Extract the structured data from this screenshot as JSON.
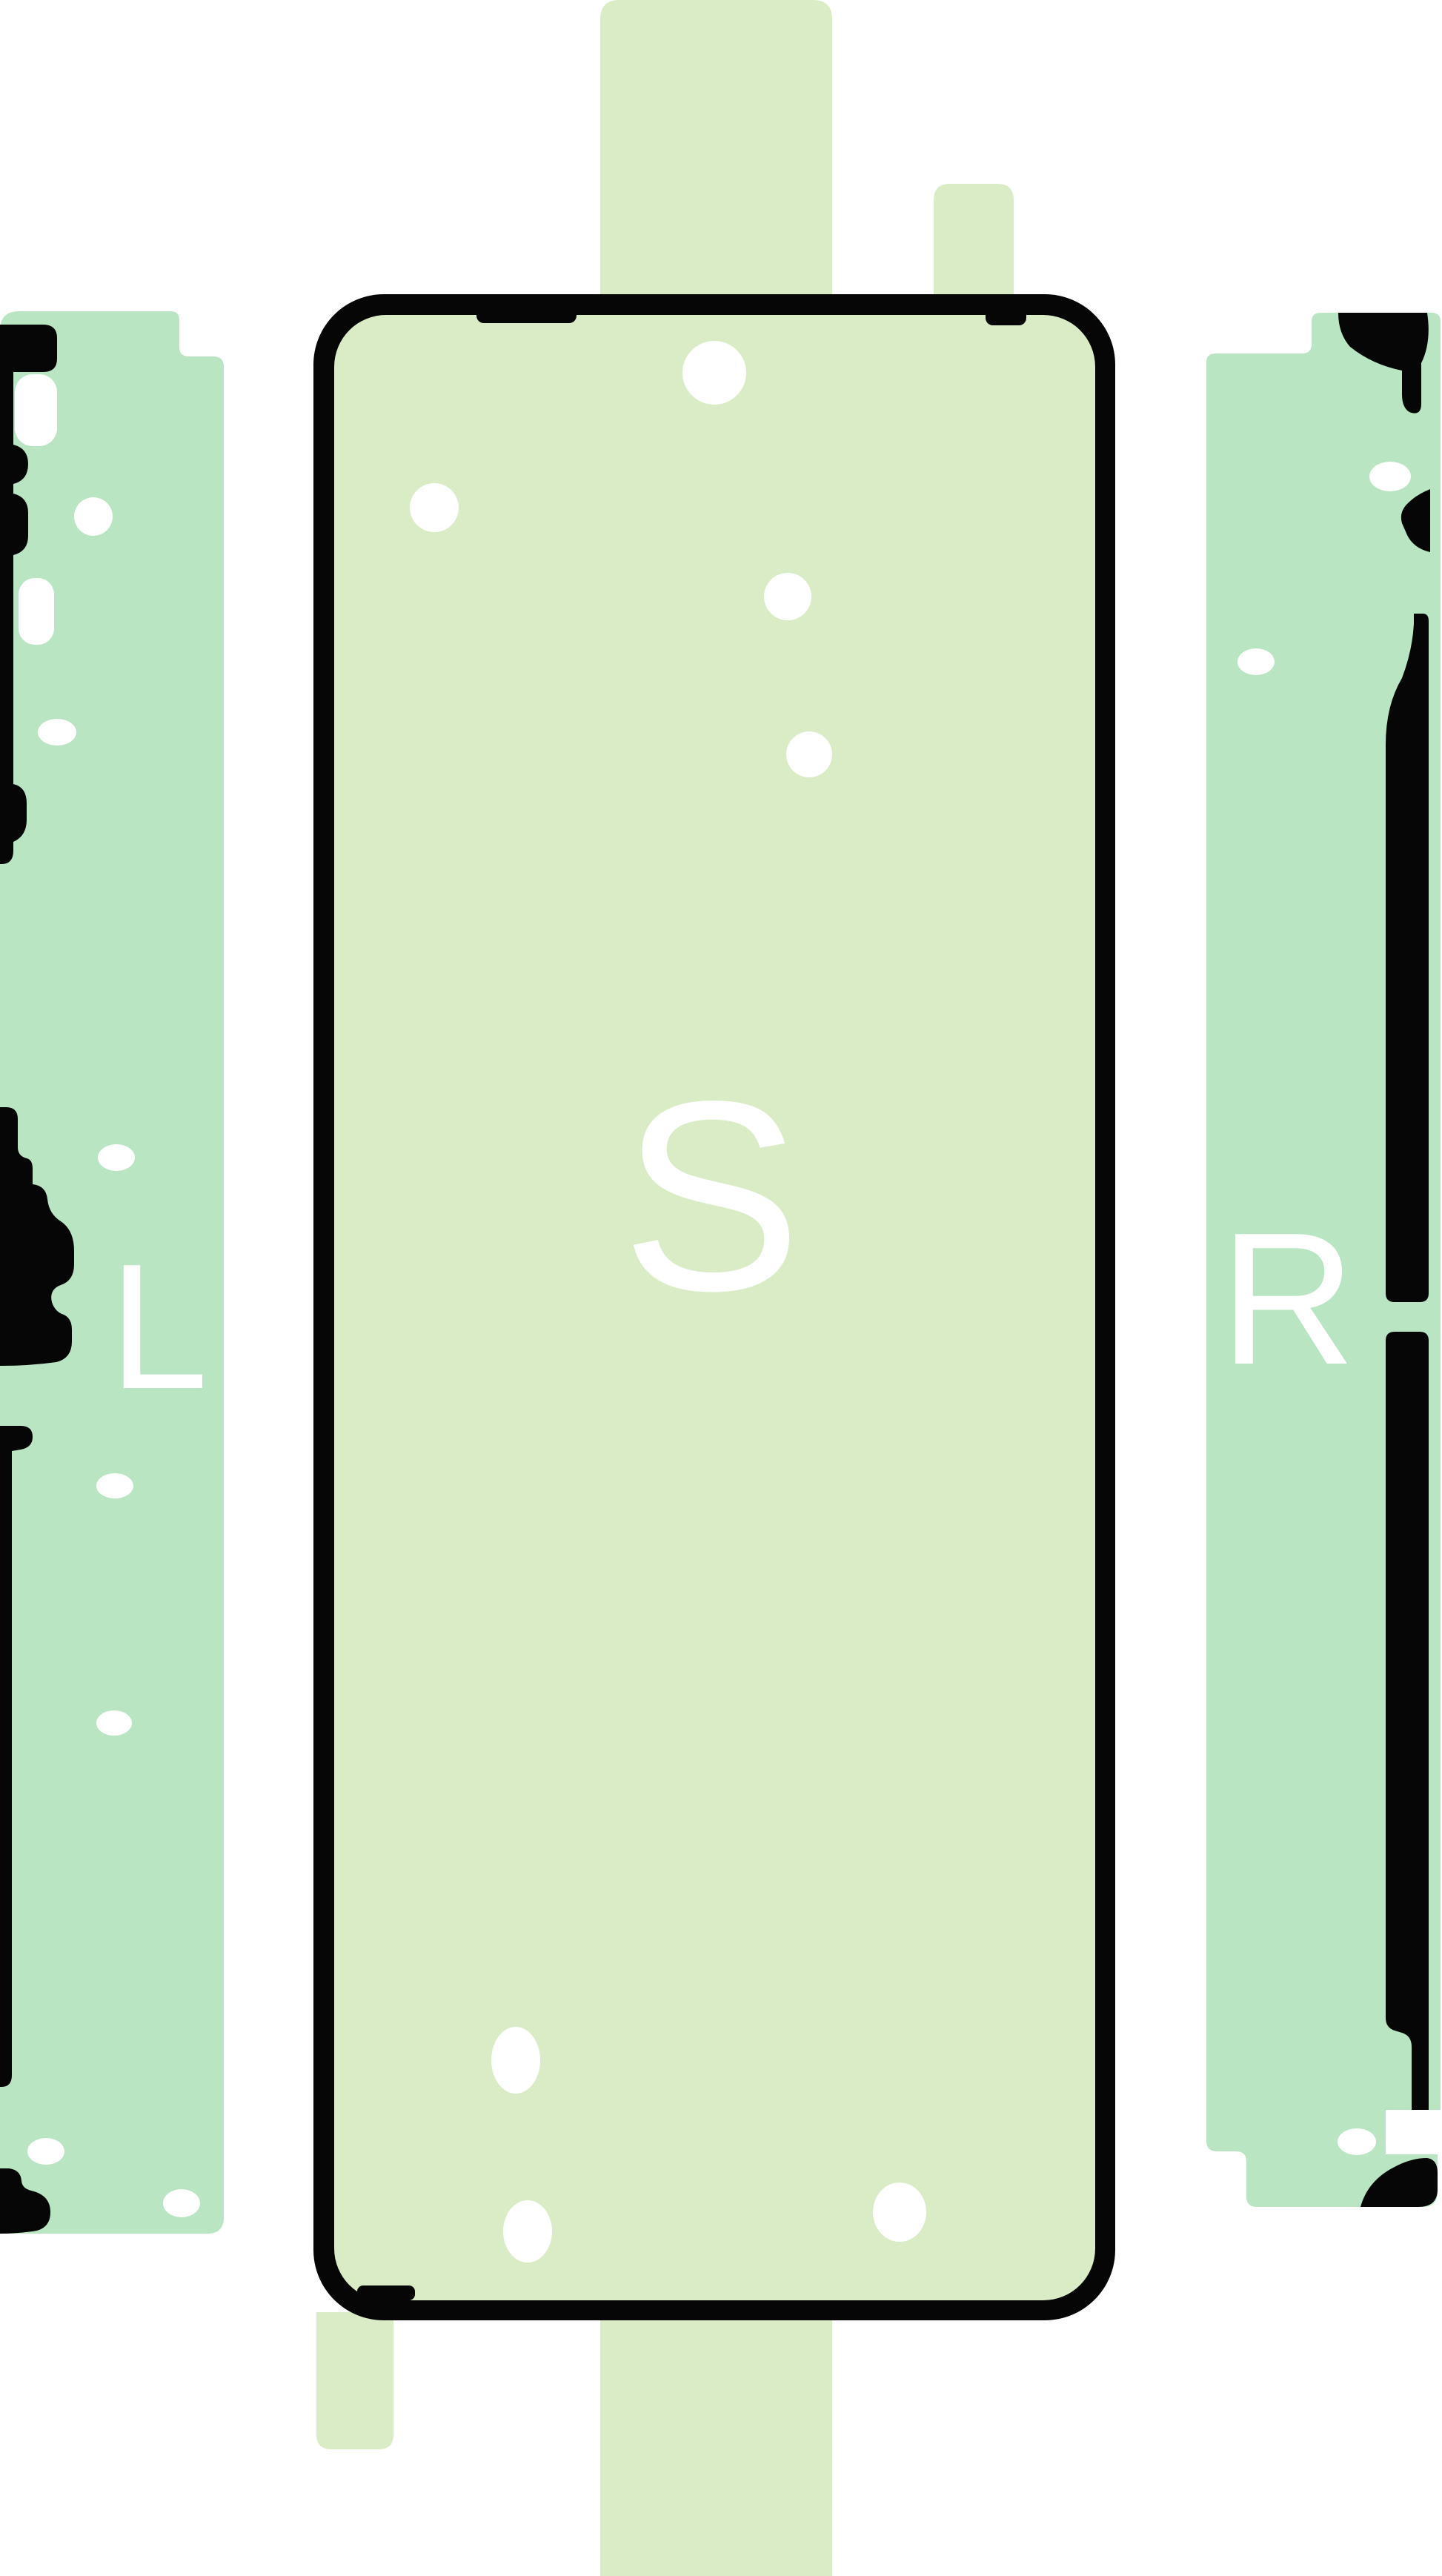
{
  "pieces": {
    "left_strip": {
      "label": "L"
    },
    "center_sheet": {
      "label": "S"
    },
    "right_strip": {
      "label": "R"
    }
  },
  "colors": {
    "background": "#ffffff",
    "backing_sheet": "#d9ecc6",
    "center_fill": "#d9ecc6",
    "strip_fill": "#b9e5c2",
    "adhesive_black": "#060606",
    "hole_white": "#ffffff",
    "label_text": "#ffffff"
  }
}
